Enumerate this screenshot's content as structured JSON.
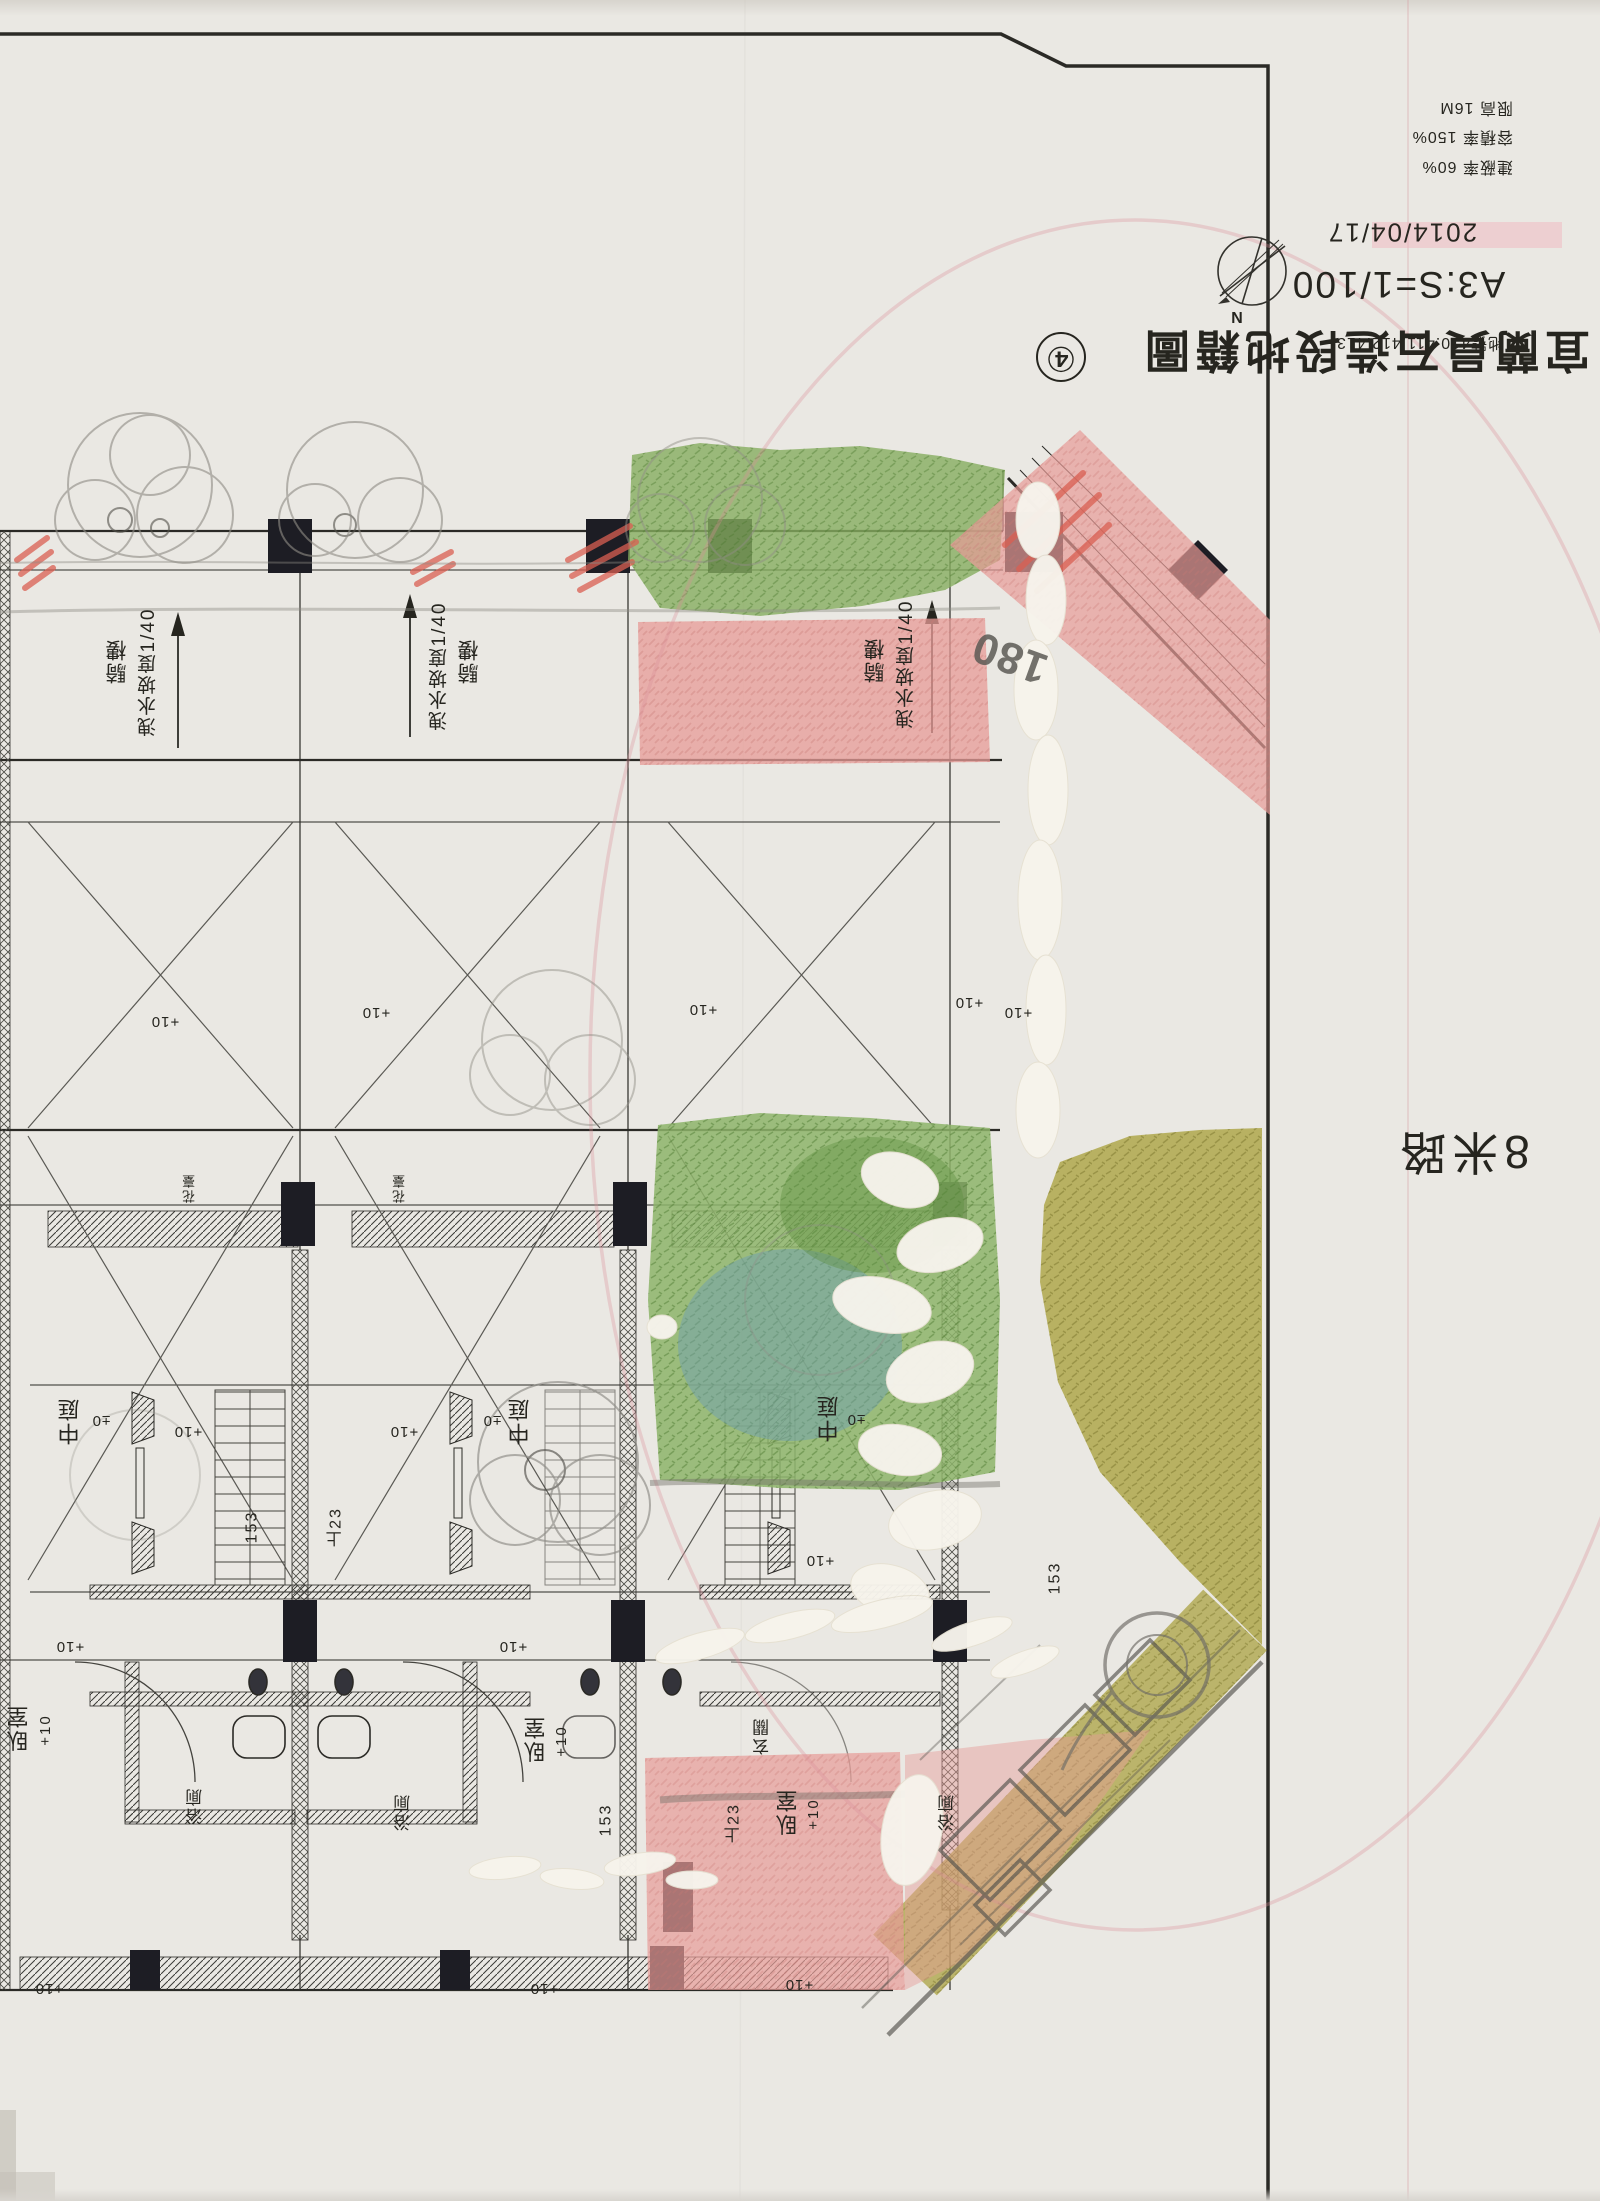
{
  "sheet": {
    "title": "宜蘭員石造段地籍圖",
    "sheet_number": "④",
    "scale": "A3:S=1/100",
    "date": "2014/04/17",
    "lot_numbers": "地號410.411.412.413",
    "road_label": "8米路",
    "north_label": "N",
    "regulations": [
      {
        "label": "建蔽率",
        "value": "60%"
      },
      {
        "label": "容積率",
        "value": "150%"
      },
      {
        "label": "限高",
        "value": "16M"
      }
    ]
  },
  "plan": {
    "labels": [
      {
        "text": "騎樓",
        "x": 118,
        "y": 661,
        "s": 21,
        "v": 1
      },
      {
        "text": "洩水坡度1/40",
        "x": 149,
        "y": 672,
        "s": 19,
        "v": 1
      },
      {
        "text": "騎樓",
        "x": 470,
        "y": 661,
        "s": 21,
        "v": 1
      },
      {
        "text": "洩水坡度1/40",
        "x": 440,
        "y": 666,
        "s": 19,
        "v": 1
      },
      {
        "text": "騎樓",
        "x": 876,
        "y": 660,
        "s": 21,
        "v": 1
      },
      {
        "text": "洩水坡度1/40",
        "x": 907,
        "y": 664,
        "s": 19,
        "v": 1
      },
      {
        "text": "180",
        "x": 1010,
        "y": 657,
        "s": 44,
        "rot": 200,
        "cls": "pencil"
      },
      {
        "text": "中庭",
        "x": 70,
        "y": 1421,
        "s": 22,
        "v": 1
      },
      {
        "text": "±0",
        "x": 101,
        "y": 1420,
        "s": 15
      },
      {
        "text": "中庭",
        "x": 520,
        "y": 1421,
        "s": 22,
        "v": 1
      },
      {
        "text": "±0",
        "x": 492,
        "y": 1420,
        "s": 15
      },
      {
        "text": "中庭",
        "x": 829,
        "y": 1418,
        "s": 22,
        "v": 1
      },
      {
        "text": "±0",
        "x": 856,
        "y": 1419,
        "s": 15
      },
      {
        "text": "臥室",
        "x": 19,
        "y": 1728,
        "s": 22,
        "v": 1
      },
      {
        "text": "+10",
        "x": 46,
        "y": 1730,
        "s": 15,
        "v": 1
      },
      {
        "text": "臥室",
        "x": 536,
        "y": 1739,
        "s": 22,
        "v": 1
      },
      {
        "text": "+10",
        "x": 562,
        "y": 1741,
        "s": 15,
        "v": 1
      },
      {
        "text": "臥室",
        "x": 788,
        "y": 1812,
        "s": 22,
        "v": 1
      },
      {
        "text": "+10",
        "x": 814,
        "y": 1814,
        "s": 15,
        "v": 1
      },
      {
        "text": "浴廁",
        "x": 196,
        "y": 1806,
        "s": 17,
        "v": 1
      },
      {
        "text": "浴廁",
        "x": 404,
        "y": 1812,
        "s": 17,
        "v": 1
      },
      {
        "text": "浴廁",
        "x": 948,
        "y": 1812,
        "s": 17,
        "v": 1
      },
      {
        "text": "玄關",
        "x": 763,
        "y": 1736,
        "s": 17,
        "v": 1
      },
      {
        "text": "花臺",
        "x": 190,
        "y": 1188,
        "s": 13,
        "v": 1
      },
      {
        "text": "花臺",
        "x": 400,
        "y": 1188,
        "s": 13,
        "v": 1
      },
      {
        "text": "153",
        "x": 253,
        "y": 1527,
        "s": 16,
        "v": 1
      },
      {
        "text": "上23",
        "x": 337,
        "y": 1527,
        "s": 16,
        "v": 1
      },
      {
        "text": "153",
        "x": 607,
        "y": 1820,
        "s": 16,
        "v": 1
      },
      {
        "text": "上23",
        "x": 735,
        "y": 1823,
        "s": 16,
        "v": 1
      },
      {
        "text": "153",
        "x": 1056,
        "y": 1578,
        "s": 16,
        "v": 1
      },
      {
        "text": "+10",
        "x": 165,
        "y": 1021,
        "s": 15
      },
      {
        "text": "+10",
        "x": 376,
        "y": 1012,
        "s": 15
      },
      {
        "text": "+10",
        "x": 703,
        "y": 1009,
        "s": 15
      },
      {
        "text": "+10",
        "x": 969,
        "y": 1002,
        "s": 15
      },
      {
        "text": "+10",
        "x": 1018,
        "y": 1012,
        "s": 15
      },
      {
        "text": "+10",
        "x": 188,
        "y": 1431,
        "s": 15
      },
      {
        "text": "+10",
        "x": 404,
        "y": 1431,
        "s": 15
      },
      {
        "text": "+10",
        "x": 820,
        "y": 1560,
        "s": 15
      },
      {
        "text": "+10",
        "x": 70,
        "y": 1646,
        "s": 15
      },
      {
        "text": "+10",
        "x": 513,
        "y": 1646,
        "s": 15
      },
      {
        "text": "+10",
        "x": 49,
        "y": 1988,
        "s": 15
      },
      {
        "text": "+10",
        "x": 544,
        "y": 1988,
        "s": 15
      },
      {
        "text": "+10",
        "x": 799,
        "y": 1984,
        "s": 15
      }
    ]
  },
  "colors": {
    "paper": "#eae8e3",
    "ink": "#26251f",
    "pencil": "#8f8d86",
    "green": "#86ad5f",
    "blue_green": "#6f9fb0",
    "olive": "#a9a13e",
    "pink": "#e79b97",
    "red_crayon": "#d95f52",
    "red_pencil": "#d98f98",
    "whiteout": "#f6f3ec"
  }
}
